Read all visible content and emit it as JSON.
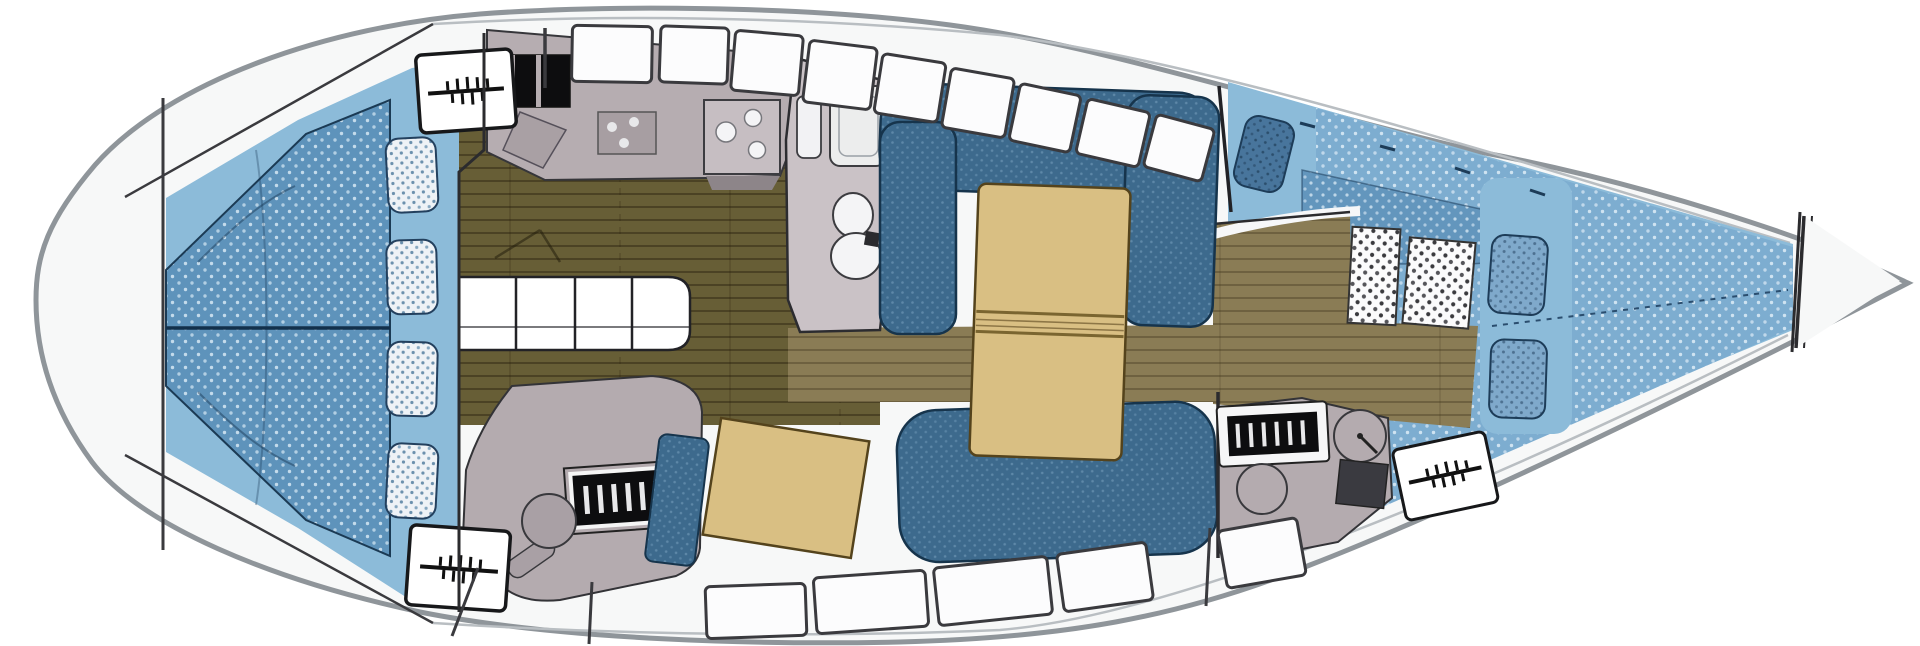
{
  "meta": {
    "title": "Sailboat interior layout — top-down floor plan",
    "diagram_type": "boat-floor-plan",
    "orientation_bow": "right",
    "orientation_stern": "left"
  },
  "colors": {
    "page_bg": "#ffffff",
    "hull_fill": "#f7f8f8",
    "hull_outline": "#8f959a",
    "sheer_line": "#b9bec2",
    "bulkhead": "#2b2b2e",
    "cabin_floor_blue": "#8cbbd9",
    "aft_mattress": "#5e93bb",
    "fwd_mattress": "#7dadd0",
    "fwd_mattress_dark": "#6396bd",
    "pillow_white": "#eef2f6",
    "pillow_blue": "#7fa9cb",
    "pillow_navy": "#48759c",
    "settee_blue": "#3d6a8d",
    "settee_outline": "#16344c",
    "table_tan": "#d9bf83",
    "table_outline": "#54431c",
    "wood_salon": "#675e36",
    "wood_corridor": "#8a7c55",
    "counter_gray": "#b6adb1",
    "counter_dark": "#a79ea2",
    "appliance_black": "#0d0d0f",
    "fixture_white": "#f2f2f4",
    "head_floor": "#cac2c6",
    "desk_gray": "#b4abaf",
    "instrument_black": "#0d0d0f",
    "instrument_tick": "#e8e8ea",
    "checker_floor": "#fbfbfc",
    "hatch_white": "#ffffff",
    "hatch_outline": "#1a1a1c",
    "seam_navy": "#12304b",
    "berth_seam": "#2a4d6e"
  },
  "regions": [
    {
      "id": "aft-cabin-berth",
      "kind": "double berth"
    },
    {
      "id": "aft-berth-pillows",
      "kind": "pillows",
      "count": 4
    },
    {
      "id": "companionway-steps",
      "kind": "steps"
    },
    {
      "id": "galley",
      "kind": "galley with stove, burners and sink"
    },
    {
      "id": "head-compartment",
      "kind": "toilet and washbasin"
    },
    {
      "id": "saloon-dinette",
      "kind": "U-shaped settee"
    },
    {
      "id": "saloon-table",
      "kind": "folding table"
    },
    {
      "id": "nav-station",
      "kind": "chart table, instrument panel, chair"
    },
    {
      "id": "forward-desk",
      "kind": "desk, instrument panel, stool, clock dial"
    },
    {
      "id": "forward-cabin-berth",
      "kind": "V-berth"
    },
    {
      "id": "forward-berth-pillows",
      "kind": "pillows",
      "count": 3
    },
    {
      "id": "anchor-locker",
      "kind": "bow locker"
    }
  ],
  "icons": [
    {
      "name": "hatch-vent-icon",
      "glyph": "horizontal line with tick marks",
      "count": 3
    },
    {
      "name": "coachroof-window",
      "glyph": "outlined rounded rectangle",
      "count_top": 9,
      "count_bottom": 6
    },
    {
      "name": "stove-icon",
      "glyph": "black twin rectangles"
    },
    {
      "name": "burner-icon",
      "glyph": "three dots"
    },
    {
      "name": "sink-icon",
      "glyph": "three circles"
    },
    {
      "name": "toilet-icon",
      "glyph": "twin ellipses"
    },
    {
      "name": "clock-dial-icon",
      "glyph": "circle with hand"
    },
    {
      "name": "stool-icon",
      "glyph": "circle"
    }
  ]
}
